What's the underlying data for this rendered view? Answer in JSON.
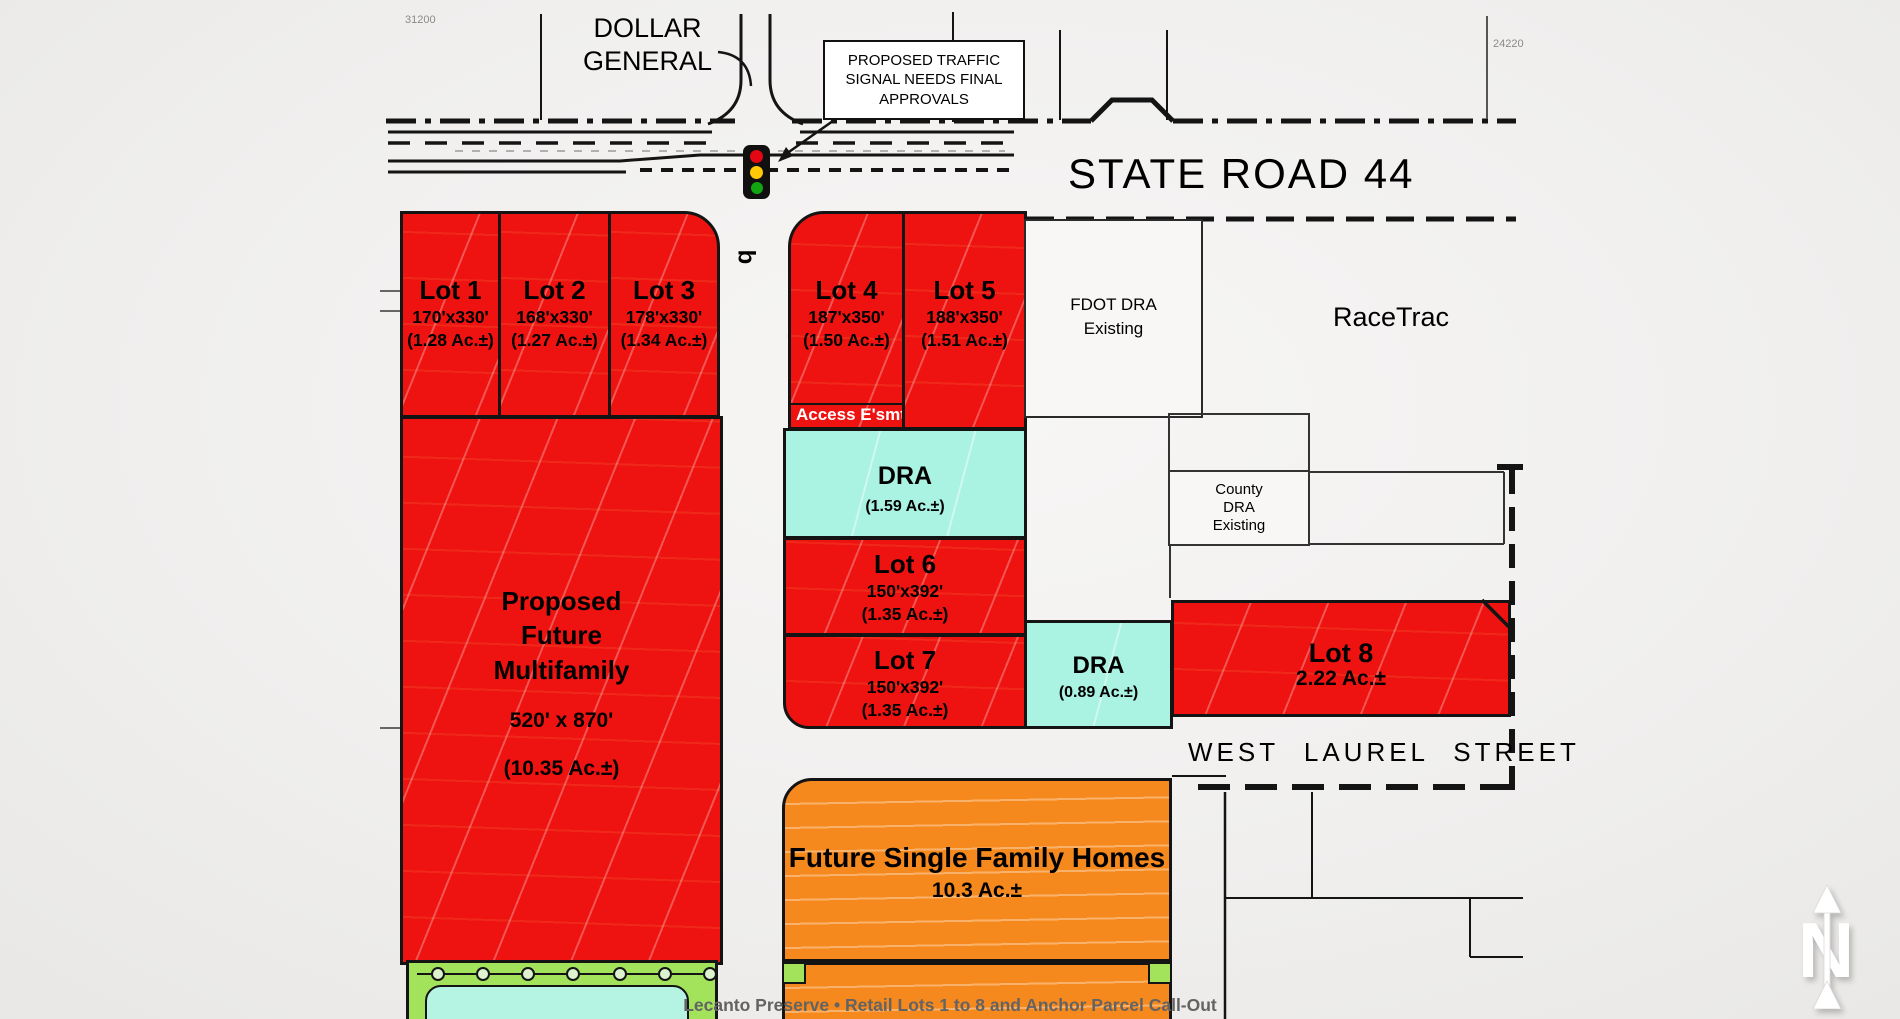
{
  "caption": "Lecanto Preserve • Retail Lots 1 to 8 and Anchor Parcel Call-Out",
  "roads": {
    "state_road": "STATE ROAD 44",
    "west_laurel": "WEST LAUREL STREET"
  },
  "landmarks": {
    "dollar_general_line1": "DOLLAR",
    "dollar_general_line2": "GENERAL",
    "racetrac": "RaceTrac"
  },
  "callout": {
    "line1": "PROPOSED TRAFFIC",
    "line2": "SIGNAL NEEDS FINAL",
    "line3": "APPROVALS"
  },
  "markers": {
    "left_parcel_number": "31200",
    "right_parcel_number": "24220",
    "road_station": "b",
    "north": "N"
  },
  "lots": [
    {
      "name": "Lot 1",
      "dims": "170'x330'",
      "area": "(1.28 Ac.±)"
    },
    {
      "name": "Lot 2",
      "dims": "168'x330'",
      "area": "(1.27 Ac.±)"
    },
    {
      "name": "Lot 3",
      "dims": "178'x330'",
      "area": "(1.34 Ac.±)"
    },
    {
      "name": "Lot 4",
      "dims": "187'x350'",
      "area": "(1.50 Ac.±)"
    },
    {
      "name": "Lot 5",
      "dims": "188'x350'",
      "area": "(1.51 Ac.±)"
    },
    {
      "name": "Lot 6",
      "dims": "150'x392'",
      "area": "(1.35 Ac.±)"
    },
    {
      "name": "Lot 7",
      "dims": "150'x392'",
      "area": "(1.35 Ac.±)"
    },
    {
      "name": "Lot 8",
      "area": "2.22 Ac.±"
    }
  ],
  "easement": {
    "label": "Access E'smt"
  },
  "dra": [
    {
      "label": "DRA",
      "area": "(1.59 Ac.±)"
    },
    {
      "label": "DRA",
      "area": "(0.89 Ac.±)"
    }
  ],
  "existing_areas": {
    "fdot_line1": "FDOT DRA",
    "fdot_line2": "Existing",
    "county_line1": "County",
    "county_line2": "DRA",
    "county_line3": "Existing"
  },
  "multifamily": {
    "line1": "Proposed",
    "line2": "Future",
    "line3": "Multifamily",
    "dims": "520' x 870'",
    "area": "(10.35 Ac.±)"
  },
  "single_family": {
    "title": "Future Single Family Homes",
    "area": "10.3 Ac.±"
  },
  "colors": {
    "lot_red": "#ee1310",
    "dra_cyan": "#aaf2e1",
    "orange": "#f6891d",
    "buffer_green": "#a3e35c",
    "pond_cyan": "#b5f3e3",
    "signal_red": "#e30613",
    "signal_amber": "#ffc907",
    "signal_green": "#12a512",
    "line_black": "#141414"
  }
}
